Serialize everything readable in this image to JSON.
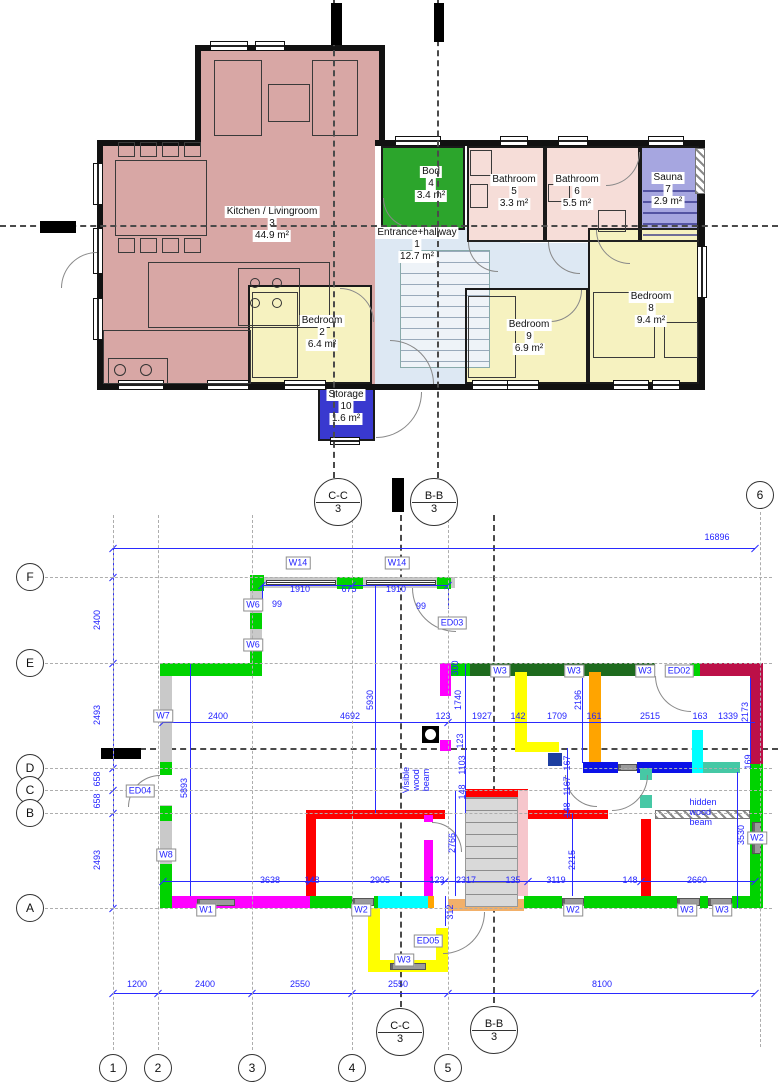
{
  "palette": {
    "dim_blue": "#2a2aff",
    "wall_gray": "#c9c9c9",
    "green": "#00d300",
    "dark_green": "#1e6b1e",
    "magenta": "#ff00ff",
    "yellow": "#ffff00",
    "orange": "#ffa400",
    "sandy": "#f2b06a",
    "cyan": "#00ffff",
    "teal": "#46c8a5",
    "blue": "#0b12e8",
    "navy": "#1e3fa0",
    "crimson": "#bc1048",
    "red": "#ff0000",
    "pink": "#f6c6cc",
    "kitchen": "#d8a7a5",
    "bedroom": "#f6f2c0",
    "bathroom": "#f6ddd8",
    "hallway": "#dde8f3",
    "bod_green": "#2ca52c",
    "sauna": "#a6a6e0",
    "storage_blue": "#3939cf"
  },
  "upper_plan": {
    "rooms": [
      {
        "name": "Kitchen / Livingroom",
        "num": "3",
        "area": "44.9 m²",
        "x": 272,
        "y": 224
      },
      {
        "name": "Entrance+hallway",
        "num": "1",
        "area": "12.7 m²",
        "x": 417,
        "y": 245
      },
      {
        "name": "Bod",
        "num": "4",
        "area": "3.4 m²",
        "x": 431,
        "y": 184
      },
      {
        "name": "Bathroom",
        "num": "5",
        "area": "3.3 m²",
        "x": 514,
        "y": 192
      },
      {
        "name": "Bathroom",
        "num": "6",
        "area": "5.5 m²",
        "x": 577,
        "y": 192
      },
      {
        "name": "Sauna",
        "num": "7",
        "area": "2.9 m²",
        "x": 668,
        "y": 190
      },
      {
        "name": "Bedroom",
        "num": "2",
        "area": "6.4 m²",
        "x": 322,
        "y": 333
      },
      {
        "name": "Bedroom",
        "num": "9",
        "area": "6.9 m²",
        "x": 529,
        "y": 337
      },
      {
        "name": "Bedroom",
        "num": "8",
        "area": "9.4 m²",
        "x": 651,
        "y": 309
      },
      {
        "name": "Storage",
        "num": "10",
        "area": "1.6 m²",
        "x": 346,
        "y": 407
      }
    ]
  },
  "lower_plan": {
    "grid_cols": [
      {
        "label": "1",
        "x": 113,
        "bubble_y": 1068
      },
      {
        "label": "2",
        "x": 158,
        "bubble_y": 1068
      },
      {
        "label": "3",
        "x": 252,
        "bubble_y": 1068
      },
      {
        "label": "4",
        "x": 352,
        "bubble_y": 1068
      },
      {
        "label": "5",
        "x": 448,
        "bubble_y": 1068
      },
      {
        "label": "6",
        "x": 760,
        "bubble_y": 495
      }
    ],
    "grid_rows": [
      {
        "label": "F",
        "y": 577
      },
      {
        "label": "E",
        "y": 663
      },
      {
        "label": "D",
        "y": 768
      },
      {
        "label": "C",
        "y": 790
      },
      {
        "label": "B",
        "y": 813
      },
      {
        "label": "A",
        "y": 908
      }
    ],
    "sections": [
      {
        "name": "C-C",
        "sheet": "3",
        "x": 338,
        "y": 502
      },
      {
        "name": "B-B",
        "sheet": "3",
        "x": 434,
        "y": 502
      },
      {
        "name": "C-C",
        "sheet": "3",
        "x": 400,
        "y": 1032
      },
      {
        "name": "B-B",
        "sheet": "3",
        "x": 494,
        "y": 1030
      }
    ],
    "dims": [
      {
        "t": "16896",
        "x": 717,
        "y": 537
      },
      {
        "t": "1910",
        "x": 300,
        "y": 589
      },
      {
        "t": "675",
        "x": 349,
        "y": 589
      },
      {
        "t": "1910",
        "x": 396,
        "y": 589
      },
      {
        "t": "99",
        "x": 277,
        "y": 604
      },
      {
        "t": "99",
        "x": 421,
        "y": 606
      },
      {
        "t": "2400",
        "x": 218,
        "y": 716
      },
      {
        "t": "4692",
        "x": 350,
        "y": 716
      },
      {
        "t": "123",
        "x": 443,
        "y": 716
      },
      {
        "t": "1927",
        "x": 482,
        "y": 716
      },
      {
        "t": "142",
        "x": 518,
        "y": 716
      },
      {
        "t": "1709",
        "x": 557,
        "y": 716
      },
      {
        "t": "161",
        "x": 594,
        "y": 716
      },
      {
        "t": "2515",
        "x": 650,
        "y": 716
      },
      {
        "t": "163",
        "x": 700,
        "y": 716
      },
      {
        "t": "1339",
        "x": 728,
        "y": 716
      },
      {
        "t": "3638",
        "x": 270,
        "y": 880
      },
      {
        "t": "148",
        "x": 312,
        "y": 880
      },
      {
        "t": "2905",
        "x": 380,
        "y": 880
      },
      {
        "t": "123",
        "x": 437,
        "y": 880
      },
      {
        "t": "2317",
        "x": 466,
        "y": 880
      },
      {
        "t": "135",
        "x": 513,
        "y": 880
      },
      {
        "t": "3119",
        "x": 556,
        "y": 880
      },
      {
        "t": "148",
        "x": 630,
        "y": 880
      },
      {
        "t": "2660",
        "x": 697,
        "y": 880
      },
      {
        "t": "1200",
        "x": 137,
        "y": 984
      },
      {
        "t": "2400",
        "x": 205,
        "y": 984
      },
      {
        "t": "2550",
        "x": 300,
        "y": 984
      },
      {
        "t": "2550",
        "x": 398,
        "y": 984
      },
      {
        "t": "8100",
        "x": 602,
        "y": 984
      },
      {
        "t": "2400",
        "x": 97,
        "y": 620,
        "v": 1
      },
      {
        "t": "2493",
        "x": 97,
        "y": 715,
        "v": 1
      },
      {
        "t": "658",
        "x": 97,
        "y": 779,
        "v": 1
      },
      {
        "t": "658",
        "x": 97,
        "y": 801,
        "v": 1
      },
      {
        "t": "2493",
        "x": 97,
        "y": 860,
        "v": 1
      },
      {
        "t": "5893",
        "x": 184,
        "y": 788,
        "v": 1
      },
      {
        "t": "5930",
        "x": 370,
        "y": 700,
        "v": 1
      },
      {
        "t": "300",
        "x": 455,
        "y": 668,
        "v": 1
      },
      {
        "t": "1740",
        "x": 458,
        "y": 700,
        "v": 1
      },
      {
        "t": "123",
        "x": 460,
        "y": 741,
        "v": 1
      },
      {
        "t": "1103",
        "x": 462,
        "y": 765,
        "v": 1
      },
      {
        "t": "148",
        "x": 462,
        "y": 792,
        "v": 1
      },
      {
        "t": "2766",
        "x": 452,
        "y": 843,
        "v": 1
      },
      {
        "t": "312",
        "x": 450,
        "y": 912,
        "v": 1
      },
      {
        "t": "2196",
        "x": 578,
        "y": 700,
        "v": 1
      },
      {
        "t": "2173",
        "x": 745,
        "y": 712,
        "v": 1
      },
      {
        "t": "167",
        "x": 567,
        "y": 763,
        "v": 1
      },
      {
        "t": "1167",
        "x": 567,
        "y": 786,
        "v": 1
      },
      {
        "t": "148",
        "x": 567,
        "y": 810,
        "v": 1
      },
      {
        "t": "2215",
        "x": 572,
        "y": 860,
        "v": 1
      },
      {
        "t": "3530",
        "x": 741,
        "y": 835,
        "v": 1
      },
      {
        "t": "169",
        "x": 748,
        "y": 762,
        "v": 1
      }
    ],
    "tags": [
      {
        "t": "W14",
        "x": 298,
        "y": 563
      },
      {
        "t": "W14",
        "x": 397,
        "y": 563
      },
      {
        "t": "W6",
        "x": 253,
        "y": 605
      },
      {
        "t": "W6",
        "x": 253,
        "y": 645
      },
      {
        "t": "W7",
        "x": 163,
        "y": 716
      },
      {
        "t": "W8",
        "x": 166,
        "y": 855
      },
      {
        "t": "ED04",
        "x": 140,
        "y": 791
      },
      {
        "t": "ED03",
        "x": 452,
        "y": 623
      },
      {
        "t": "W3",
        "x": 500,
        "y": 671
      },
      {
        "t": "W3",
        "x": 574,
        "y": 671
      },
      {
        "t": "W3",
        "x": 645,
        "y": 671
      },
      {
        "t": "ED02",
        "x": 679,
        "y": 671
      },
      {
        "t": "W2",
        "x": 757,
        "y": 838
      },
      {
        "t": "W1",
        "x": 206,
        "y": 910
      },
      {
        "t": "W2",
        "x": 361,
        "y": 910
      },
      {
        "t": "W2",
        "x": 573,
        "y": 910
      },
      {
        "t": "W3",
        "x": 687,
        "y": 910
      },
      {
        "t": "W3",
        "x": 722,
        "y": 910
      },
      {
        "t": "W3",
        "x": 404,
        "y": 960
      },
      {
        "t": "ED05",
        "x": 428,
        "y": 941
      }
    ],
    "notes": [
      {
        "text": "Visible wood beam",
        "lines": [
          "Visible",
          "wood",
          "beam"
        ],
        "x": 416,
        "y": 780,
        "v": 1
      },
      {
        "text": "hidden wood beam",
        "lines": [
          "hidden",
          "wood",
          "beam"
        ],
        "x": 703,
        "y": 812,
        "v": 0
      }
    ]
  }
}
